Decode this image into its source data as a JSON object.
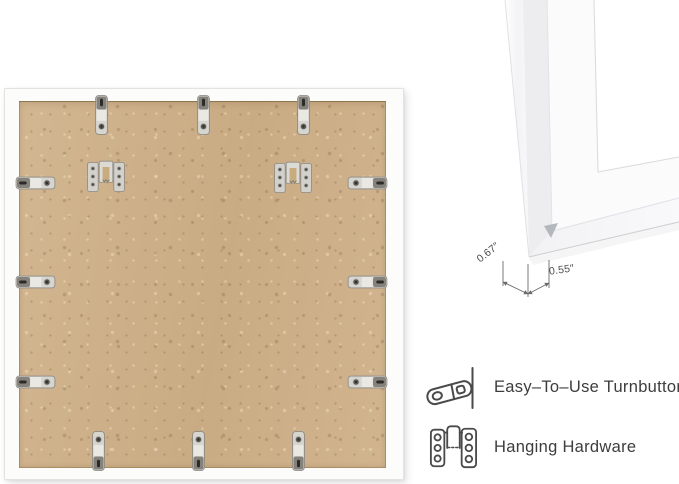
{
  "page": {
    "background": "#ffffff"
  },
  "photo": {
    "frame_color": "#fcfcfb",
    "backing_color": "#cfb189",
    "turnbutton_count": 12,
    "sawtooth_hanger_count": 2
  },
  "dimension_diagram": {
    "moulding_width_label": "0.67″",
    "moulding_depth_label": "0.55″"
  },
  "features": [
    {
      "icon": "turnbutton-icon",
      "label": "Easy–To–Use Turnbuttons"
    },
    {
      "icon": "hanging-hardware-icon",
      "label": "Hanging Hardware"
    }
  ],
  "colors": {
    "feature_text": "#3d3d3d",
    "dimension_text": "#4d4d4d",
    "icon_stroke": "#4a4a4a",
    "metal_hardware": "#d7d5d0"
  }
}
